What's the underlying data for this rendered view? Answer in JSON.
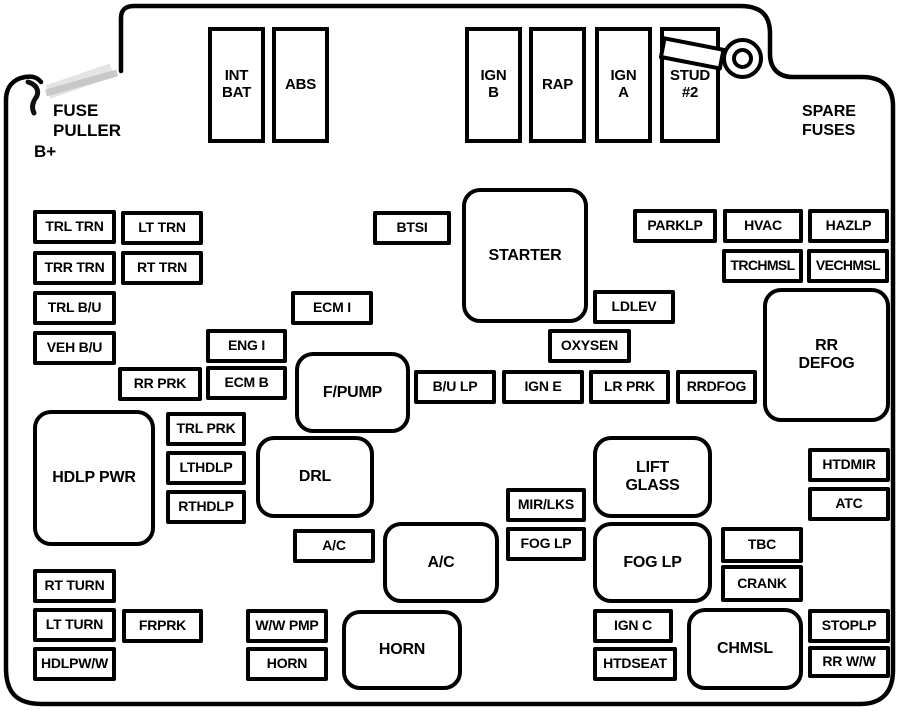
{
  "colors": {
    "line": "#000000",
    "background": "#ffffff",
    "smudge": "#c4c4c4"
  },
  "annotations": {
    "fuse_puller": "FUSE\nPULLER",
    "b_plus": "B+",
    "spare_fuses": "SPARE\nFUSES"
  },
  "icons": {
    "stud_ring": "stud-ring-icon",
    "stud_tab": "stud-tab-icon",
    "fuse_puller_mark": "fuse-puller-icon",
    "fusebox_outline": "fusebox-outline"
  },
  "fuses": {
    "int_bat": "INT\nBAT",
    "abs": "ABS",
    "ign_b": "IGN\nB",
    "rap": "RAP",
    "ign_a": "IGN\nA",
    "stud2": "STUD\n#2",
    "trl_trn": "TRL TRN",
    "lt_trn": "LT TRN",
    "trr_trn": "TRR TRN",
    "rt_trn": "RT TRN",
    "trl_bu": "TRL B/U",
    "veh_bu": "VEH B/U",
    "rr_prk": "RR PRK",
    "ecm_b": "ECM B",
    "eng_i": "ENG I",
    "ecm_i": "ECM I",
    "btsi": "BTSI",
    "starter": "STARTER",
    "parklp": "PARKLP",
    "hvac": "HVAC",
    "hazlp": "HAZLP",
    "trchmsl": "TRCHMSL",
    "vechmsl": "VECHMSL",
    "ldlev": "LDLEV",
    "oxysen": "OXYSEN",
    "rr_defog": "RR\nDEFOG",
    "f_pump": "F/PUMP",
    "bu_lp": "B/U LP",
    "ign_e": "IGN E",
    "lr_prk": "LR PRK",
    "rrdfog": "RRDFOG",
    "hdlp_pwr": "HDLP PWR",
    "trl_prk": "TRL PRK",
    "lthdlp": "LTHDLP",
    "rthdlp": "RTHDLP",
    "drl": "DRL",
    "lift_glass": "LIFT\nGLASS",
    "htdmir": "HTDMIR",
    "atc": "ATC",
    "mir_lks": "MIR/LKS",
    "fog_lp_small": "FOG LP",
    "ac_small": "A/C",
    "ac_large": "A/C",
    "fog_lp_large": "FOG LP",
    "tbc": "TBC",
    "crank": "CRANK",
    "rt_turn": "RT TURN",
    "lt_turn": "LT TURN",
    "frprk": "FRPRK",
    "hdlpww": "HDLPW/W",
    "ww_pmp": "W/W PMP",
    "horn_small": "HORN",
    "horn_large": "HORN",
    "ign_c": "IGN C",
    "htdseat": "HTDSEAT",
    "chmsl": "CHMSL",
    "stoplp": "STOPLP",
    "rr_ww": "RR W/W"
  }
}
